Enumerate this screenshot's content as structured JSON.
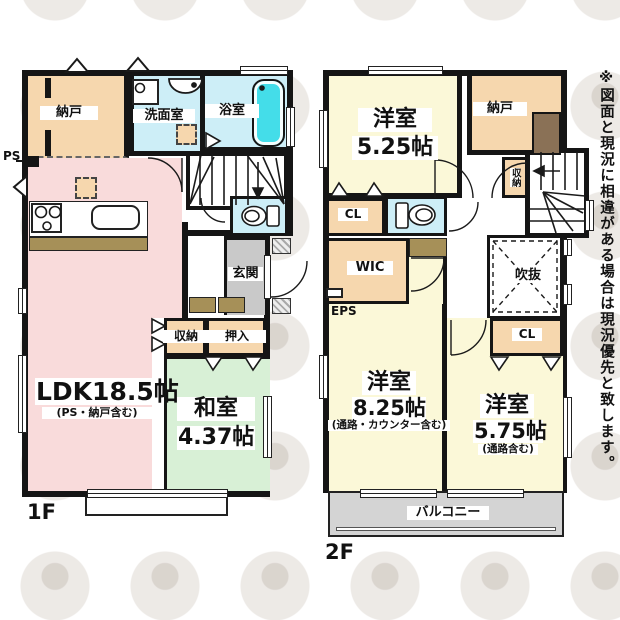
{
  "disclaimer": "※図面と現況に相違がある場合は現況優先と致します。",
  "floor1": {
    "label": "1F",
    "rooms": {
      "nando": "納戸",
      "senmenshitsu": "洗面室",
      "yokushitsu": "浴室",
      "ps": "PS",
      "ldk": "LDK18.5帖",
      "ldk_note": "(PS・納戸含む)",
      "shuno": "収納",
      "oshiire": "押入",
      "washitsu": "和室",
      "washitsu_size": "4.37帖",
      "genkan": "玄関"
    }
  },
  "floor2": {
    "label": "2F",
    "rooms": {
      "yoshitsu_a": "洋室",
      "yoshitsu_a_size": "5.25帖",
      "nando": "納戸",
      "cl_a": "CL",
      "shuno": "収納",
      "wic": "WIC",
      "eps": "EPS",
      "fukinuke": "吹抜",
      "yoshitsu_b": "洋室",
      "yoshitsu_b_size": "8.25帖",
      "yoshitsu_b_note": "(通路・カウンター含む)",
      "yoshitsu_c": "洋室",
      "yoshitsu_c_size": "5.75帖",
      "yoshitsu_c_note": "(通路含む)",
      "cl_b": "CL",
      "balcony": "バルコニー"
    }
  },
  "colors": {
    "wall": "#151515",
    "ldk_pink": "#f9dbdb",
    "tatami_green": "#d8f0d6",
    "bedroom_yellow": "#fbf8d8",
    "closet_orange": "#f6d7ae",
    "wet_area_blue": "#cdeef7",
    "bathtub_cyan": "#44dde9",
    "entry_gray": "#c9c9c9",
    "balcony_gray": "#d4d4d4",
    "counter_brown": "#a69058",
    "dark_closet_brown": "#8a7156"
  },
  "icons": [
    "bathtub-icon",
    "toilet-icon",
    "stove-icon",
    "sink-icon",
    "washbasin-icon",
    "washing-machine-icon",
    "stairs-down-arrow-icon",
    "stairs-left-arrow-icon",
    "vent-triangle-icon",
    "door-arc-icon"
  ]
}
